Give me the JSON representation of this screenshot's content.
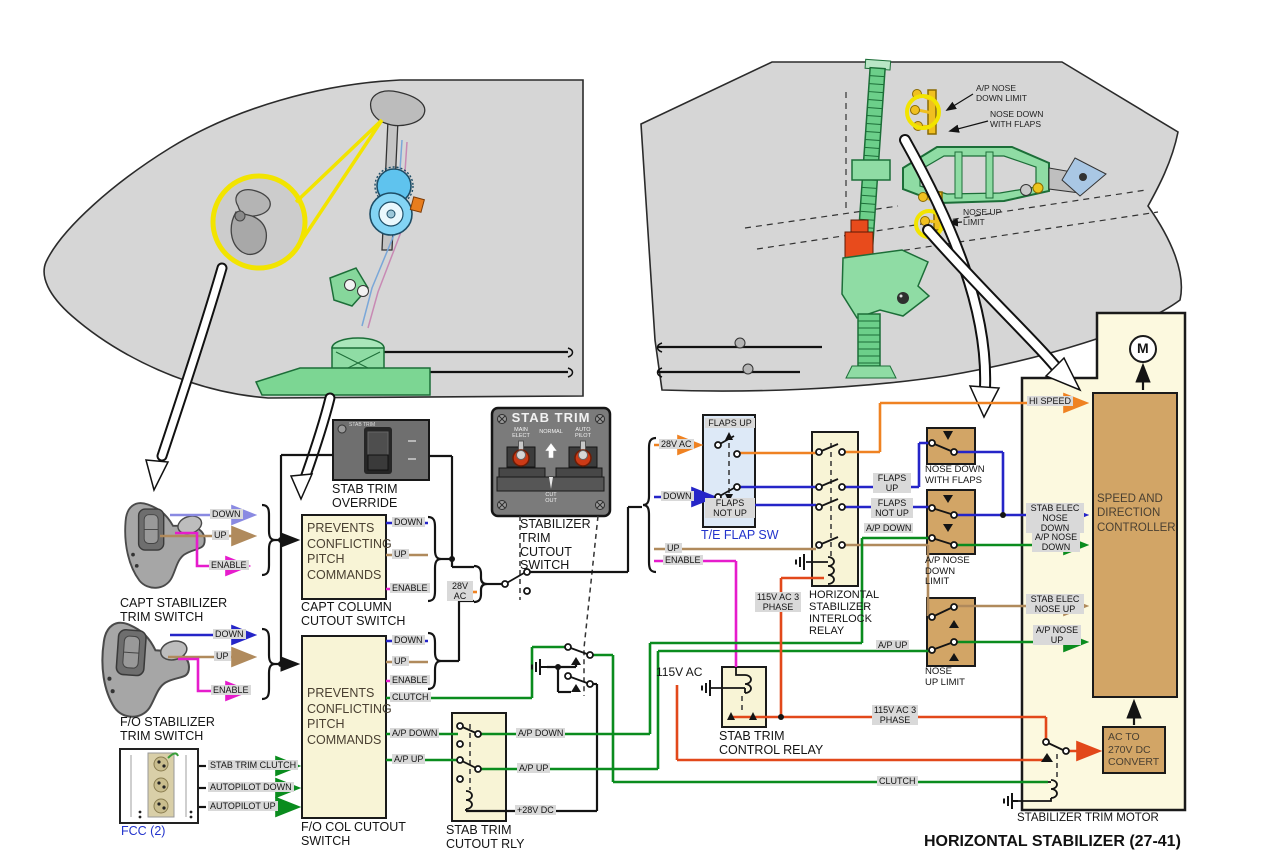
{
  "title": "HORIZONTAL STABILIZER (27-41)",
  "tail": {
    "ap_nose_down_limit": "A/P NOSE DOWN LIMIT",
    "nose_down_with_flaps": "NOSE DOWN WITH FLAPS",
    "nose_up_limit": "NOSE UP LIMIT"
  },
  "panels": {
    "override": {
      "title": "STAB TRIM",
      "label": "STAB TRIM OVERRIDE"
    },
    "cutout": {
      "title": "STAB TRIM",
      "main_elect": "MAIN ELECT",
      "normal": "NORMAL",
      "auto_pilot": "AUTO PILOT",
      "cut_out": "CUT OUT",
      "label": "STABILIZER TRIM CUTOUT SWITCH"
    }
  },
  "capt": {
    "label": "CAPT STABILIZER TRIM SWITCH",
    "down": "DOWN",
    "up": "UP",
    "enable": "ENABLE"
  },
  "fo": {
    "label": "F/O STABILIZER TRIM SWITCH",
    "down": "DOWN",
    "up": "UP",
    "enable": "ENABLE"
  },
  "fcc": {
    "label": "FCC (2)",
    "stab_trim_clutch": "STAB TRIM CLUTCH",
    "autopilot_down": "AUTOPILOT DOWN",
    "autopilot_up": "AUTOPILOT UP"
  },
  "capt_box": {
    "body": "PREVENTS CONFLICTING PITCH COMMANDS",
    "label": "CAPT COLUMN CUTOUT SWITCH",
    "down": "DOWN",
    "up": "UP",
    "enable": "ENABLE"
  },
  "fo_box": {
    "body": "PREVENTS CONFLICTING PITCH COMMANDS",
    "label": "F/O COL CUTOUT SWITCH",
    "down": "DOWN",
    "up": "UP",
    "enable": "ENABLE",
    "clutch": "CLUTCH",
    "ap_down": "A/P DOWN",
    "ap_up": "A/P UP"
  },
  "bus28": {
    "v28": "28V AC"
  },
  "bundle": {
    "v28": "28V AC",
    "down": "DOWN",
    "up": "UP",
    "enable": "ENABLE"
  },
  "te_flap": {
    "flaps_up": "FLAPS UP",
    "flaps_not_up": "FLAPS NOT UP",
    "label": "T/E FLAP SW"
  },
  "interlock": {
    "label": "HORIZONTAL STABILIZER INTERLOCK RELAY",
    "supply": "115V AC 3 PHASE"
  },
  "outs": {
    "flaps_up": "FLAPS UP",
    "flaps_not_up": "FLAPS NOT UP",
    "ap_down": "A/P DOWN",
    "ap_up": "A/P UP",
    "clutch": "CLUTCH"
  },
  "rly": {
    "label": "STAB TRIM CUTOUT RLY",
    "ap_down": "A/P DOWN",
    "ap_up": "A/P UP",
    "coil": "+28V DC"
  },
  "ctl_relay": {
    "label": "STAB TRIM CONTROL RELAY",
    "supply": "115V AC",
    "out": "115V AC 3 PHASE"
  },
  "limits": {
    "nose_down_with_flaps": "NOSE DOWN WITH FLAPS",
    "ap_nose_down_limit": "A/P NOSE DOWN LIMIT",
    "nose_up_limit": "NOSE UP LIMIT"
  },
  "ctrl_in": {
    "hi_speed": "HI SPEED",
    "stab_elec_nose_down": "STAB ELEC NOSE DOWN",
    "ap_nose_down": "A/P NOSE DOWN",
    "stab_elec_nose_up": "STAB ELEC NOSE UP",
    "ap_nose_up": "A/P NOSE UP"
  },
  "motor": {
    "label": "STABILIZER TRIM MOTOR",
    "controller": "SPEED AND DIRECTION CONTROLLER",
    "converter": "AC TO 270V DC CONVERT",
    "m": "M"
  },
  "colors": {
    "down_wire": "#2525c8",
    "capt_down_wire": "#8a8ae2",
    "up_wire": "#b08a5c",
    "enable_wire": "#e61ccc",
    "green_wire": "#0a8c1e",
    "orange_wire": "#ef8222",
    "red_115v_wire": "#e2481a",
    "highlight": "#f2e400"
  }
}
